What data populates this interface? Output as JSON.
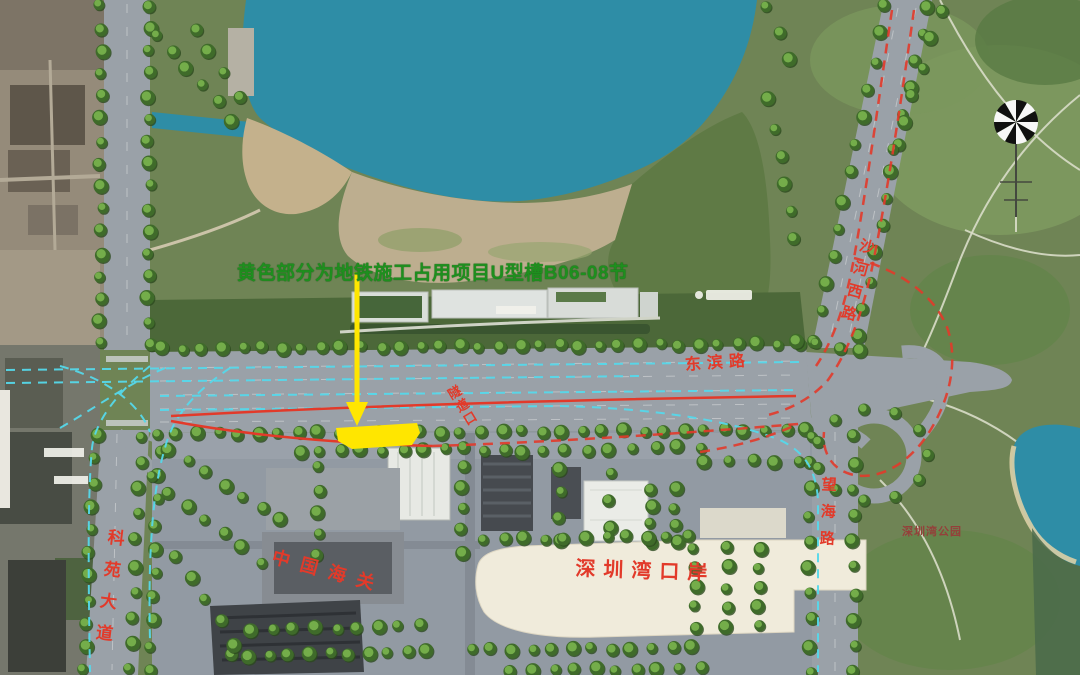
{
  "labels": {
    "note": "黄色部分为地铁施工占用项目U型槽B06-08节",
    "dongbin": "东滨路",
    "shahe_west": "沙河西路",
    "keyuan": "科苑大道",
    "wanghai": "望海路",
    "tunnel_portal": "隧道口",
    "customs": "中国海关",
    "bay_port": "深圳湾口岸",
    "bay_park": "深圳湾公园"
  },
  "colors": {
    "annotation_green": "#1e8f1e",
    "label_red": "#e23a2a",
    "label_dark_red": "#94403a",
    "highlight_yellow": "#ffe600",
    "metro_cyan": "#55d8ea",
    "water_teal": "#2e8da6",
    "road_gray": "#9aa1a8",
    "tree_green": "#6fae4e",
    "park_green": "#6f8455"
  }
}
